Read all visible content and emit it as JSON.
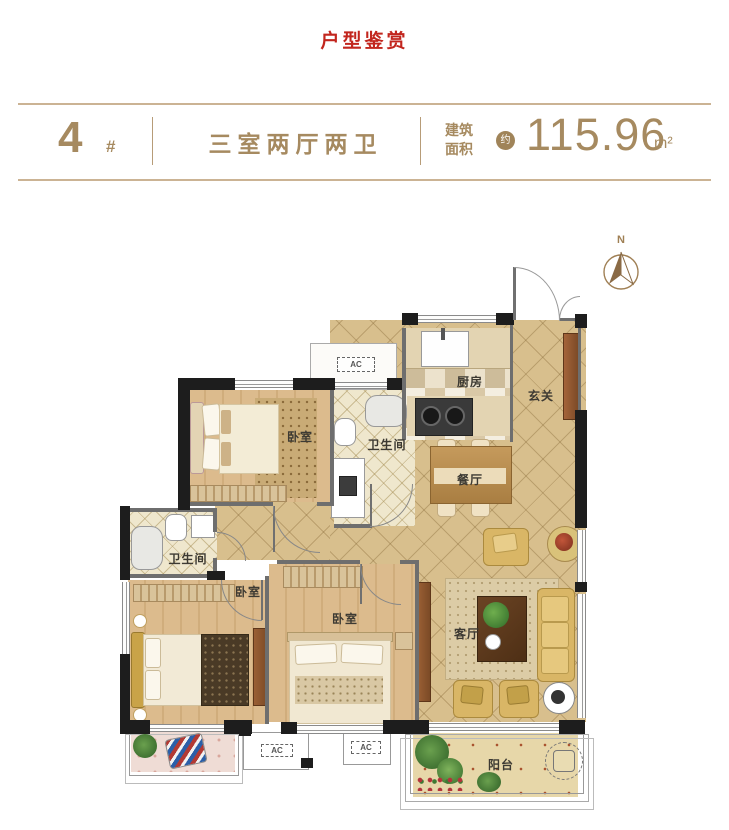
{
  "title": "户型鉴赏",
  "header": {
    "unit_number": "4",
    "unit_hash": "#",
    "layout": "三室两厅两卫",
    "area_label_top": "建筑",
    "area_label_bottom": "面积",
    "approx": "约",
    "area_value": "115.96",
    "area_unit": "m²"
  },
  "compass": {
    "north_label": "N"
  },
  "rooms": {
    "kitchen": "厨房",
    "foyer": "玄关",
    "bedroom_top": "卧室",
    "bathroom_top": "卫生间",
    "dining": "餐厅",
    "bathroom_left": "卫生间",
    "bedroom_left": "卧室",
    "bedroom_middle": "卧室",
    "living": "客厅",
    "balcony": "阳台"
  },
  "annotations": {
    "ac": "AC"
  },
  "colors": {
    "title_red": "#c2261e",
    "header_tan": "#a68a60",
    "wall_black": "#1d1d1d",
    "tile_tan": "#d8bf8d",
    "wood": "#dcbb8d"
  }
}
